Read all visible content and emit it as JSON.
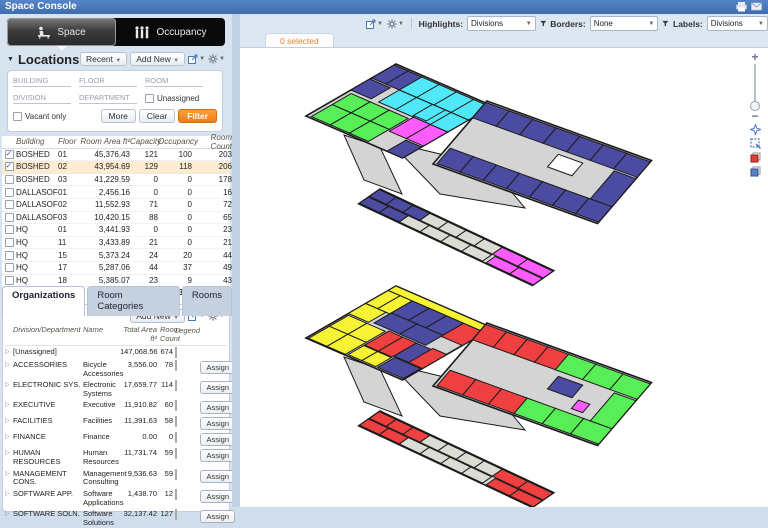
{
  "title": "Space Console",
  "tabs": [
    {
      "label": "Space"
    },
    {
      "label": "Occupancy"
    }
  ],
  "locations": {
    "header": "Locations",
    "recent_label": "Recent",
    "add_new_label": "Add New",
    "filters": {
      "building_placeholder": "BUILDING",
      "floor_placeholder": "FLOOR",
      "room_placeholder": "ROOM",
      "division_placeholder": "DIVISION",
      "department_placeholder": "DEPARTMENT",
      "unassigned_label": "Unassigned",
      "vacant_label": "Vacant only",
      "more_label": "More",
      "clear_label": "Clear",
      "filter_label": "Filter"
    },
    "grid": {
      "columns": [
        "Building",
        "Floor",
        "Room Area ft²",
        "Capacity",
        "Occupancy",
        "Room Count"
      ],
      "rows": [
        {
          "checked": true,
          "selected": false,
          "building": "BOSHED",
          "floor": "01",
          "area": "45,376.43",
          "capacity": "121",
          "occupancy": "100",
          "count": "203"
        },
        {
          "checked": true,
          "selected": true,
          "building": "BOSHED",
          "floor": "02",
          "area": "43,954.69",
          "capacity": "129",
          "occupancy": "118",
          "count": "206"
        },
        {
          "checked": false,
          "selected": false,
          "building": "BOSHED",
          "floor": "03",
          "area": "41,229.59",
          "capacity": "0",
          "occupancy": "0",
          "count": "178"
        },
        {
          "checked": false,
          "selected": false,
          "building": "DALLASOF",
          "floor": "01",
          "area": "2,456.16",
          "capacity": "0",
          "occupancy": "0",
          "count": "16"
        },
        {
          "checked": false,
          "selected": false,
          "building": "DALLASOF",
          "floor": "02",
          "area": "11,552.93",
          "capacity": "71",
          "occupancy": "0",
          "count": "72"
        },
        {
          "checked": false,
          "selected": false,
          "building": "DALLASOF",
          "floor": "03",
          "area": "10,420.15",
          "capacity": "88",
          "occupancy": "0",
          "count": "65"
        },
        {
          "checked": false,
          "selected": false,
          "building": "HQ",
          "floor": "01",
          "area": "3,441.93",
          "capacity": "0",
          "occupancy": "0",
          "count": "23"
        },
        {
          "checked": false,
          "selected": false,
          "building": "HQ",
          "floor": "11",
          "area": "3,433.89",
          "capacity": "21",
          "occupancy": "0",
          "count": "21"
        },
        {
          "checked": false,
          "selected": false,
          "building": "HQ",
          "floor": "15",
          "area": "5,373.24",
          "capacity": "24",
          "occupancy": "20",
          "count": "44"
        },
        {
          "checked": false,
          "selected": false,
          "building": "HQ",
          "floor": "17",
          "area": "5,287.06",
          "capacity": "44",
          "occupancy": "37",
          "count": "49"
        },
        {
          "checked": false,
          "selected": false,
          "building": "HQ",
          "floor": "18",
          "area": "5,385.07",
          "capacity": "23",
          "occupancy": "9",
          "count": "43"
        }
      ],
      "totals": {
        "area": "246,431.27",
        "capacity": "794",
        "occupancy": "366",
        "count": "1,225"
      }
    }
  },
  "organizations": {
    "tabs": [
      "Organizations",
      "Room Categories",
      "Rooms"
    ],
    "add_new_label": "Add New",
    "columns": {
      "division": "Division/Department",
      "name": "Name",
      "area": "Total Area ft²",
      "count": "Room Count",
      "legend": "Legend"
    },
    "assign_label": "Assign",
    "rows": [
      {
        "division": "[Unassigned]",
        "name": "",
        "area": "147,068.56",
        "count": "674",
        "color": "#ecece0",
        "hatch": "#e2e2d2",
        "assign": false
      },
      {
        "division": "ACCESSORIES",
        "name": "Bicycle Accessories",
        "area": "3,556.00",
        "count": "78",
        "color": "#6673e6",
        "hatch": null,
        "assign": true
      },
      {
        "division": "ELECTRONIC SYS.",
        "name": "Electronic Systems",
        "area": "17,659.77",
        "count": "114",
        "color": "#54eefc",
        "hatch": null,
        "assign": true
      },
      {
        "division": "EXECUTIVE",
        "name": "Executive",
        "area": "11,910.82",
        "count": "60",
        "color": "#63f063",
        "hatch": null,
        "assign": true
      },
      {
        "division": "FACILITIES",
        "name": "Facilities",
        "area": "11,391.63",
        "count": "58",
        "color": "#fbfb6e",
        "hatch": null,
        "assign": true
      },
      {
        "division": "FINANCE",
        "name": "Finance",
        "area": "0.00",
        "count": "0",
        "color": "#c2c2c2",
        "hatch": null,
        "assign": true
      },
      {
        "division": "HUMAN RESOURCES",
        "name": "Human Resources",
        "area": "11,731.74",
        "count": "59",
        "color": "#fb6a58",
        "hatch": null,
        "assign": true
      },
      {
        "division": "MANAGEMENT CONS.",
        "name": "Management Consulting",
        "area": "9,536.63",
        "count": "59",
        "color": "#fc6afc",
        "hatch": null,
        "assign": true
      },
      {
        "division": "SOFTWARE APP.",
        "name": "Software Applications",
        "area": "1,438.70",
        "count": "12",
        "color": "#a0a0a0",
        "hatch": "#787878",
        "assign": true
      },
      {
        "division": "SOFTWARE SOLN.",
        "name": "Software Solutions",
        "area": "32,137.42",
        "count": "127",
        "color": "#6a76b8",
        "hatch": null,
        "assign": true
      }
    ]
  },
  "viewer": {
    "selected_tab": "0 selected",
    "highlights_label": "Highlights:",
    "highlights_value": "Divisions",
    "borders_label": "Borders:",
    "borders_value": "None",
    "labels_label": "Labels:",
    "labels_value": "Divisions"
  },
  "floorplan": {
    "colors": {
      "blue": "#4b4ba2",
      "cyan": "#50e8f8",
      "green": "#58ee58",
      "magenta": "#ff5cff",
      "yellow": "#f6f334",
      "red": "#ee4040",
      "gray2": "#dcdcd4",
      "white": "#ffffff",
      "base": "#d4d4d4",
      "outline": "#1b1b1b"
    },
    "floors": [
      {
        "dy": 0,
        "polys": [
          [
            [
              104,
              87
            ],
            [
              140,
              99
            ],
            [
              162,
              146
            ],
            [
              124,
              132
            ]
          ],
          [
            [
              150,
              94
            ],
            [
              250,
              118
            ],
            [
              285,
              160
            ],
            [
              200,
              146
            ]
          ]
        ],
        "wings": [
          {
            "m": [
              0.92,
              0.4,
              -0.866,
              0.5,
              156,
              16
            ],
            "base": [
              0,
              0,
              105,
              104
            ],
            "strips": [
              [
                0,
                2,
                30,
                26,
                2,
                "blue"
              ],
              [
                30,
                2,
                75,
                26,
                4,
                "cyan"
              ],
              [
                30,
                28,
                75,
                24,
                4,
                "cyan"
              ],
              [
                66,
                28,
                14,
                22,
                1,
                "cyan"
              ],
              [
                0,
                30,
                22,
                22,
                1,
                "blue"
              ],
              [
                4,
                56,
                62,
                22,
                3,
                "green"
              ],
              [
                4,
                78,
                62,
                24,
                3,
                "green"
              ],
              [
                68,
                52,
                37,
                28,
                2,
                "magenta"
              ],
              [
                88,
                82,
                17,
                22,
                1,
                "blue"
              ]
            ]
          },
          {
            "m": [
              0.94,
              0.34,
              -0.6,
              0.7,
              247,
              53
            ],
            "base": [
              0,
              0,
              175,
              90
            ],
            "strips": [
              [
                0,
                2,
                175,
                22,
                7,
                "blue"
              ],
              [
                3,
                66,
                172,
                22,
                7,
                "blue"
              ],
              [
                152,
                26,
                23,
                40,
                1,
                "blue"
              ],
              [
                95,
                30,
                26,
                18,
                1,
                "white"
              ]
            ]
          },
          {
            "m": [
              0.905,
              0.425,
              -0.82,
              0.57,
              140,
              141
            ],
            "base": [
              0,
              0,
              192,
              26
            ],
            "strips": [
              [
                0,
                1,
                56,
                12,
                3,
                "blue"
              ],
              [
                56,
                1,
                80,
                12,
                4,
                "gray2"
              ],
              [
                136,
                1,
                56,
                12,
                2,
                "magenta"
              ],
              [
                0,
                14,
                44,
                11,
                2,
                "blue"
              ],
              [
                44,
                14,
                92,
                11,
                4,
                "gray2"
              ],
              [
                140,
                14,
                52,
                11,
                2,
                "magenta"
              ]
            ]
          }
        ]
      },
      {
        "dy": 222,
        "polys": [
          [
            [
              104,
              87
            ],
            [
              140,
              99
            ],
            [
              162,
              146
            ],
            [
              124,
              132
            ]
          ],
          [
            [
              150,
              94
            ],
            [
              250,
              118
            ],
            [
              285,
              160
            ],
            [
              200,
              146
            ]
          ]
        ],
        "wings": [
          {
            "m": [
              0.92,
              0.4,
              -0.866,
              0.5,
              156,
              16
            ],
            "base": [
              0,
              0,
              105,
              104
            ],
            "strips": [
              [
                0,
                0,
                105,
                9,
                1,
                "yellow"
              ],
              [
                0,
                9,
                26,
                26,
                2,
                "yellow"
              ],
              [
                26,
                9,
                56,
                24,
                3,
                "blue"
              ],
              [
                26,
                33,
                56,
                20,
                2,
                "blue"
              ],
              [
                82,
                9,
                23,
                26,
                1,
                "red"
              ],
              [
                0,
                35,
                22,
                20,
                1,
                "yellow"
              ],
              [
                44,
                55,
                30,
                28,
                2,
                "red"
              ],
              [
                74,
                55,
                16,
                26,
                1,
                "blue"
              ],
              [
                90,
                53,
                15,
                28,
                1,
                "red"
              ],
              [
                2,
                57,
                40,
                22,
                2,
                "yellow"
              ],
              [
                2,
                79,
                40,
                24,
                2,
                "yellow"
              ],
              [
                44,
                84,
                30,
                18,
                2,
                "yellow"
              ],
              [
                76,
                82,
                28,
                20,
                1,
                "blue"
              ]
            ]
          },
          {
            "m": [
              0.94,
              0.34,
              -0.6,
              0.7,
              247,
              53
            ],
            "base": [
              0,
              0,
              175,
              90
            ],
            "strips": [
              [
                0,
                2,
                88,
                22,
                4,
                "red"
              ],
              [
                88,
                2,
                87,
                22,
                3,
                "green"
              ],
              [
                3,
                66,
                82,
                22,
                3,
                "red"
              ],
              [
                85,
                66,
                90,
                22,
                3,
                "green"
              ],
              [
                152,
                26,
                23,
                40,
                1,
                "green"
              ],
              [
                95,
                30,
                26,
                18,
                1,
                "blue"
              ],
              [
                128,
                48,
                12,
                12,
                1,
                "magenta"
              ]
            ]
          },
          {
            "m": [
              0.905,
              0.425,
              -0.82,
              0.57,
              140,
              141
            ],
            "base": [
              0,
              0,
              192,
              26
            ],
            "strips": [
              [
                0,
                1,
                56,
                12,
                3,
                "red"
              ],
              [
                56,
                1,
                80,
                12,
                4,
                "gray2"
              ],
              [
                136,
                1,
                56,
                12,
                2,
                "red"
              ],
              [
                0,
                14,
                44,
                11,
                2,
                "red"
              ],
              [
                44,
                14,
                92,
                11,
                4,
                "gray2"
              ],
              [
                140,
                14,
                52,
                11,
                2,
                "red"
              ]
            ]
          }
        ]
      }
    ]
  }
}
